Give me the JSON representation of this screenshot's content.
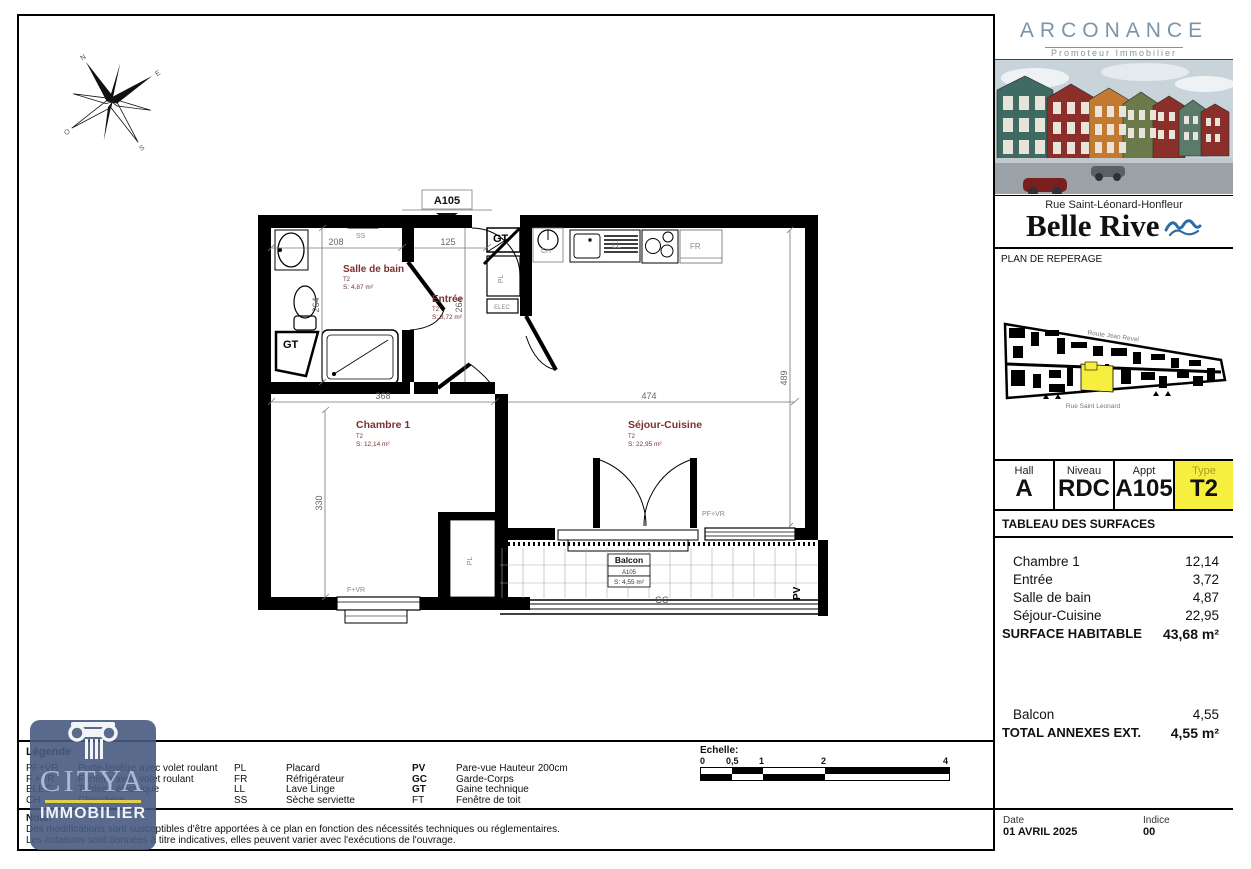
{
  "plan": {
    "apartment_tag": "A105",
    "rooms": {
      "salle_de_bain": {
        "name": "Salle de bain",
        "type": "T2",
        "surface": "S: 4,87 m²"
      },
      "entree": {
        "name": "Entrée",
        "type": "T2",
        "surface": "S: 3,72 m²"
      },
      "chambre1": {
        "name": "Chambre 1",
        "type": "T2",
        "surface": "S: 12,14 m²"
      },
      "sejour": {
        "name": "Séjour-Cuisine",
        "type": "T2",
        "surface": "S: 22,95 m²"
      },
      "balcon": {
        "name": "Balcon",
        "tag": "A105",
        "surface": "S: 4,55 m²"
      }
    },
    "dims": {
      "d208": "208",
      "d125": "125",
      "d264a": "264",
      "d264b": "264",
      "d368": "368",
      "d474": "474",
      "d330": "330",
      "d489": "489"
    },
    "fixtures": {
      "ss": "SS",
      "gt_bath": "GT",
      "gt_top": "GT",
      "ch": "CH",
      "ll": "LL",
      "fr": "FR",
      "pl_entree": "PL",
      "pl_chambre": "PL",
      "elec": "ELEC",
      "fvr": "F+VR",
      "pfvr": "PF+VR",
      "gc": "GC",
      "pv": "PV"
    },
    "compass": {
      "n": "N",
      "s": "S",
      "e": "E",
      "o": "O"
    }
  },
  "legend": {
    "title": "Légende",
    "col1": [
      {
        "abbr": "PF+VR",
        "desc": "Porte-fenêtre avec volet roulant"
      },
      {
        "abbr": "F +VR",
        "desc": "Fenêtre avec volet roulant"
      },
      {
        "abbr": "ELEC",
        "desc": "Tableau électrique"
      },
      {
        "abbr": "CH",
        "desc": "Chaudière"
      }
    ],
    "col2": [
      {
        "abbr": "PL",
        "desc": "Placard"
      },
      {
        "abbr": "FR",
        "desc": "Réfrigérateur"
      },
      {
        "abbr": "LL",
        "desc": "Lave Linge"
      },
      {
        "abbr": "SS",
        "desc": "Sèche serviette"
      }
    ],
    "col3": [
      {
        "abbr": "PV",
        "desc": "Pare-vue Hauteur 200cm"
      },
      {
        "abbr": "GC",
        "desc": "Garde-Corps"
      },
      {
        "abbr": "GT",
        "desc": "Gaine technique"
      },
      {
        "abbr": "FT",
        "desc": "Fenêtre de toit"
      }
    ]
  },
  "nota": {
    "title": "Nota:",
    "line1": "Des modifications sont susceptibles d'être apportées à ce plan en fonction des nécessités techniques ou réglementaires.",
    "line2": "Les cotations sont données à titre indicatives, elles peuvent varier avec l'exécutions de l'ouvrage."
  },
  "scale": {
    "title": "Echelle:",
    "ticks": [
      "0",
      "0,5",
      "1",
      "2",
      "4"
    ]
  },
  "watermark": {
    "brand": "CITYA",
    "sub": "IMMOBILIER"
  },
  "sidebar": {
    "developer": {
      "name": "ARCONANCE",
      "tagline": "Promoteur Immobilier"
    },
    "project": {
      "address": "Rue Saint-Léonard-Honfleur",
      "name": "Belle Rive"
    },
    "reperage": {
      "title": "PLAN DE REPERAGE",
      "road_top": "Route Jean Revel",
      "road_bottom": "Rue Saint Leonard"
    },
    "unit_table": {
      "cells": [
        {
          "label": "Hall",
          "value": "A"
        },
        {
          "label": "Niveau",
          "value": "RDC"
        },
        {
          "label": "Appt",
          "value": "A105"
        },
        {
          "label": "Type",
          "value": "T2"
        }
      ]
    },
    "surfaces": {
      "title": "TABLEAU DES SURFACES",
      "rows": [
        {
          "label": "Chambre 1",
          "value": "12,14"
        },
        {
          "label": "Entrée",
          "value": "3,72"
        },
        {
          "label": "Salle de bain",
          "value": "4,87"
        },
        {
          "label": "Séjour-Cuisine",
          "value": "22,95"
        }
      ],
      "total_label": "SURFACE HABITABLE",
      "total_value": "43,68 m²",
      "annex_rows": [
        {
          "label": "Balcon",
          "value": "4,55"
        }
      ],
      "annex_total_label": "TOTAL ANNEXES EXT.",
      "annex_total_value": "4,55 m²"
    },
    "footer": {
      "date_label": "Date",
      "date_value": "01 AVRIL 2025",
      "indice_label": "Indice",
      "indice_value": "00"
    }
  },
  "colors": {
    "highlight_yellow": "#f7ef3f",
    "room_label": "#7b3030",
    "watermark_blue": "#485a80",
    "wave_blue": "#2e6da4",
    "developer_blue": "#7b95a8"
  }
}
